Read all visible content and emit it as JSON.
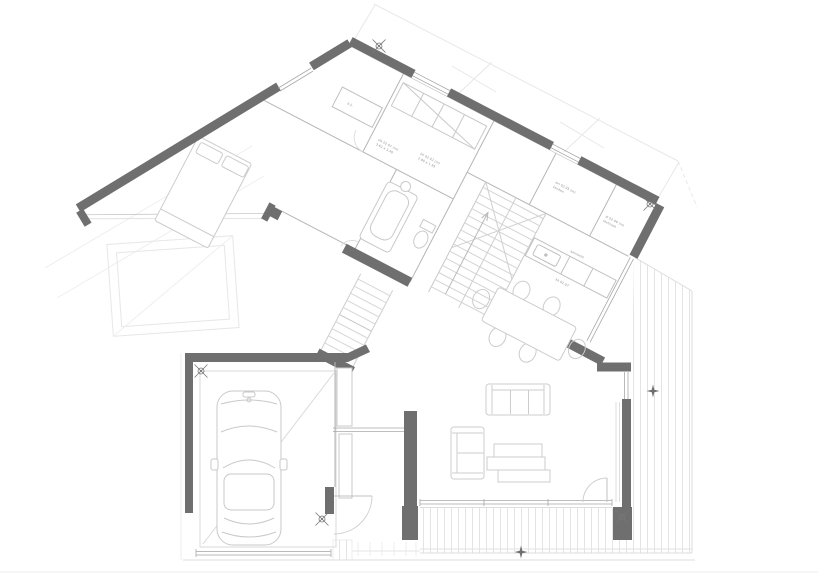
{
  "page": {
    "background": "#ffffff"
  },
  "palette": {
    "wall": "#6f6f6f",
    "partition": "#b5b5b5",
    "window": "#a8a8a8",
    "furniture": "#cccccc",
    "faint": "#e8e8e8",
    "hatch": "#e4e4e4",
    "label_text": "#8f8f8f",
    "marker": "#6f6f6f"
  },
  "plan": {
    "labels": [
      {
        "text": "b.k."
      },
      {
        "text": "slk 02.01 (m)"
      },
      {
        "text": "3.62 x 3.40"
      },
      {
        "text": "bk 02.02 (m)"
      },
      {
        "text": "2.80 x 1.95"
      },
      {
        "text": "wn 02.05 (m)"
      },
      {
        "text": "keuken"
      },
      {
        "text": "st 02.06 (m)"
      },
      {
        "text": "techniek"
      },
      {
        "text": "aanrecht"
      },
      {
        "text": "kk 02.07"
      }
    ],
    "symbols": [
      "survey-marker",
      "star-marker"
    ]
  }
}
